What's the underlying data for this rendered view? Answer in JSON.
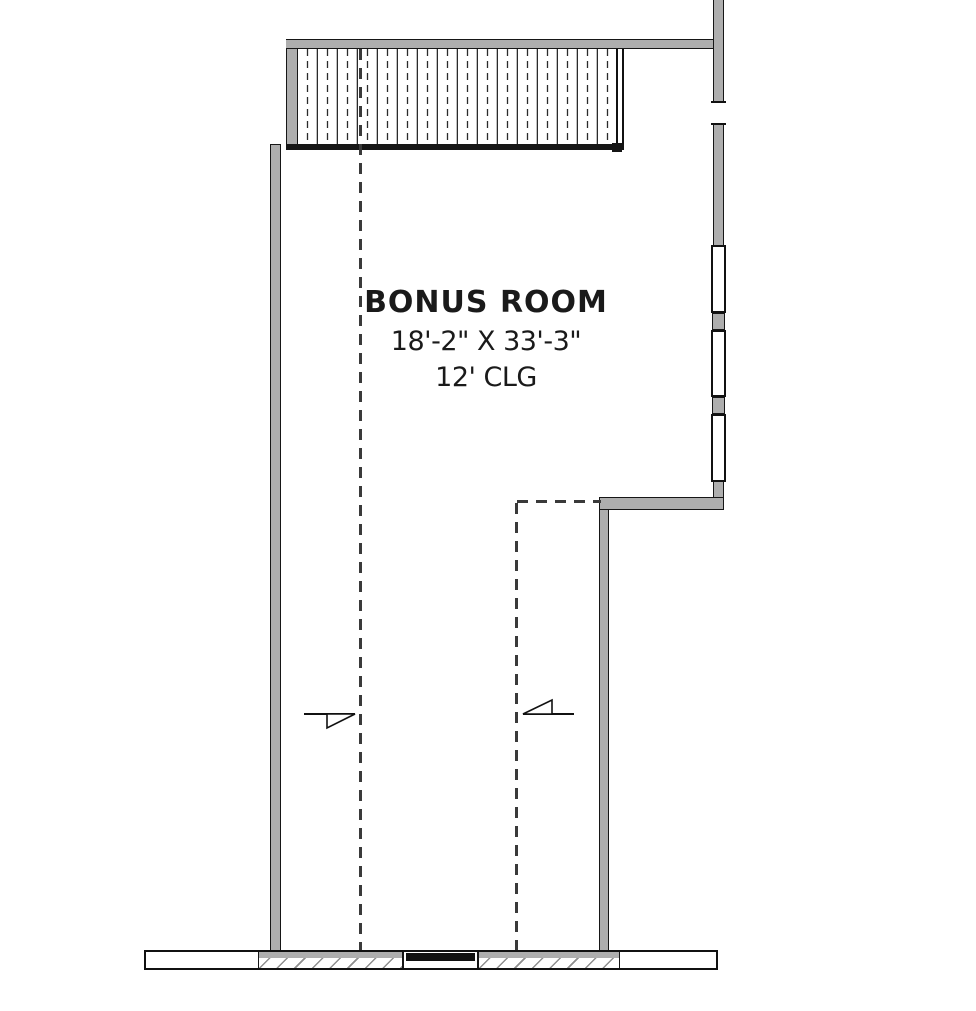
{
  "canvas": {
    "width": 976,
    "height": 1011,
    "background": "#ffffff"
  },
  "room": {
    "name": "BONUS ROOM",
    "dimensions": "18'-2\" X 33'-3\"",
    "ceiling_height": "12' CLG"
  },
  "colors": {
    "wall_fill": "#aeaeae",
    "line": "#161616",
    "hatch_line": "#8f8f8f",
    "break_line_dash": "#3a3a3a",
    "window_frame": "#111111"
  },
  "plan_features": {
    "stair_tread_count": 16,
    "right_wall_window_count": 3,
    "slope_arrow_count": 2,
    "ceiling_break_line_count": 2
  }
}
